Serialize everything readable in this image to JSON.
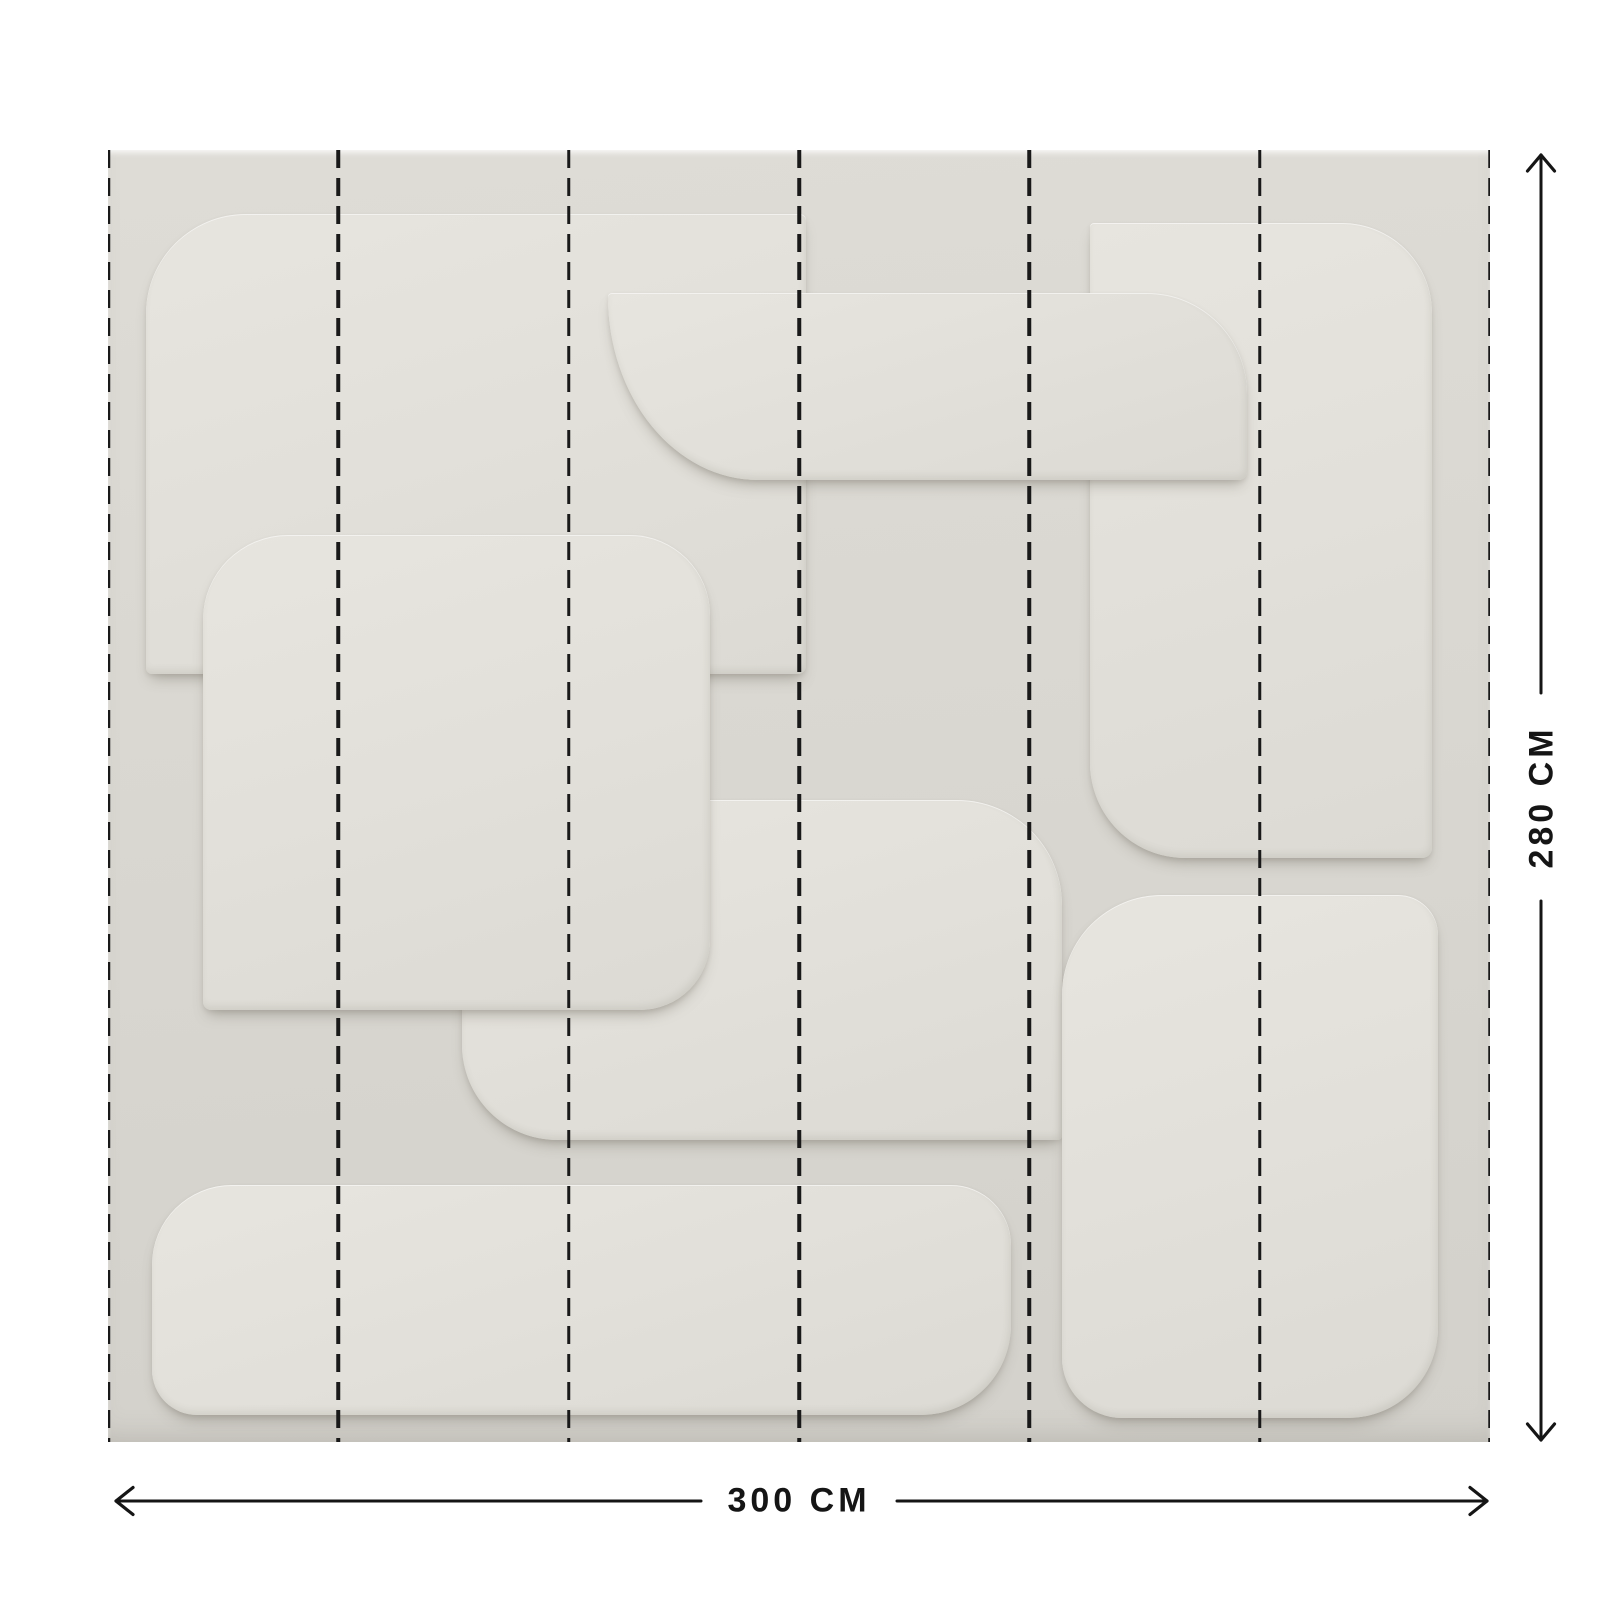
{
  "diagram": {
    "width_label": "300 CM",
    "height_label": "280 CM",
    "panel_count": 6,
    "annotation_color": "#151515",
    "mural": {
      "left": 108,
      "top": 150,
      "width": 1382,
      "height": 1292,
      "base_color": "#d9d7d1",
      "relief_color": "#e3e1db",
      "seam_line_color": "#191919",
      "seam_dash_px": 18,
      "seam_gap_px": 10,
      "seam_positions_pct": [
        0,
        16.667,
        33.333,
        50,
        66.667,
        83.333,
        100
      ],
      "relief_shapes": [
        {
          "name": "center-band",
          "left": 354,
          "top": 650,
          "width": 600,
          "height": 340,
          "radius": "4px 105px 4px 95px"
        },
        {
          "name": "top-left-slab",
          "left": 38,
          "top": 64,
          "width": 660,
          "height": 460,
          "radius": "100px 6px 8px 6px"
        },
        {
          "name": "left-square",
          "left": 95,
          "top": 385,
          "width": 507,
          "height": 475,
          "radius": "85px 80px 70px 8px"
        },
        {
          "name": "right-column",
          "left": 982,
          "top": 73,
          "width": 342,
          "height": 635,
          "radius": "4px 90px 10px 95px"
        },
        {
          "name": "top-bar",
          "left": 500,
          "top": 143,
          "width": 639,
          "height": 187,
          "radius": "4px 100px 8px 150px / 4px 100px 8px 183px"
        },
        {
          "name": "bottom-right-square",
          "left": 954,
          "top": 745,
          "width": 376,
          "height": 523,
          "radius": "100px 40px 90px 60px"
        },
        {
          "name": "bottom-band",
          "left": 44,
          "top": 1035,
          "width": 859,
          "height": 230,
          "radius": "80px 60px 90px 45px"
        }
      ]
    }
  }
}
